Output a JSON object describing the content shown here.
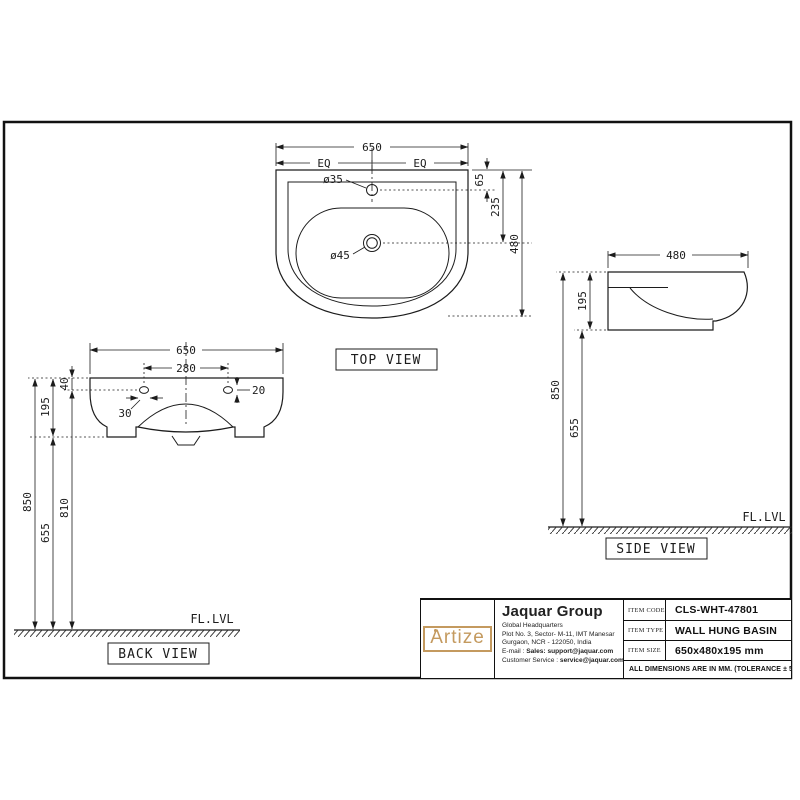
{
  "top_view": {
    "title": "TOP VIEW",
    "dim_width": "650",
    "dim_eq_left": "EQ",
    "dim_eq_right": "EQ",
    "dim_tap_hole_dia": "ø35",
    "dim_drain_dia": "ø45",
    "dim_tap_from_rear": "65",
    "dim_drain_from_rear": "235",
    "dim_depth": "480"
  },
  "back_view": {
    "title": "BACK VIEW",
    "dim_width": "650",
    "dim_hole_spacing": "280",
    "dim_hole_from_top": "40",
    "dim_basin_height": "195",
    "dim_slot_width": "30",
    "dim_slot_height": "20",
    "dim_rim_height": "850",
    "dim_hole_height": "810",
    "dim_underside_height": "655",
    "floor_label": "FL.LVL"
  },
  "side_view": {
    "title": "SIDE VIEW",
    "dim_depth": "480",
    "dim_basin_height": "195",
    "dim_rim_height": "850",
    "dim_underside_height": "655",
    "floor_label": "FL.LVL"
  },
  "title_block": {
    "logo_text": "Artize",
    "logo_color": "#c49a5f",
    "company": "Jaquar Group",
    "address_line1": "Global Headquarters",
    "address_line2": "Plot No. 3, Sector- M-11, IMT Manesar",
    "address_line3": "Gurgaon, NCR - 122050, India",
    "email_label": "E-mail : ",
    "email_value": "Sales: support@jaquar.com",
    "service_label": "Customer Service : ",
    "service_value": "service@jaquar.com",
    "fields": [
      {
        "label": "ITEM CODE",
        "value": "CLS-WHT-47801"
      },
      {
        "label": "ITEM TYPE",
        "value": "WALL HUNG BASIN"
      },
      {
        "label": "ITEM SIZE",
        "value": "650x480x195 mm"
      }
    ],
    "note": "ALL DIMENSIONS ARE IN MM. (TOLERANCE ± 5 MM)"
  }
}
